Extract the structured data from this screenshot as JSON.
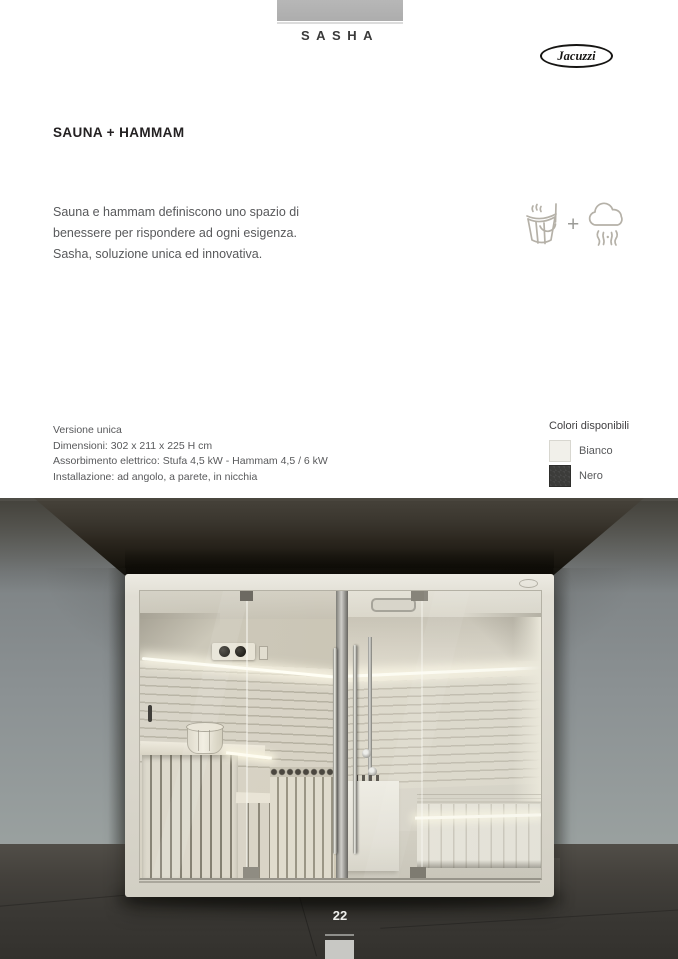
{
  "header": {
    "series": "SASHA",
    "brand": "Jacuzzi"
  },
  "main": {
    "title": "SAUNA + HAMMAM",
    "description_lines": [
      "Sauna e hammam definiscono uno spazio di",
      "benessere per rispondere ad ogni esigenza.",
      "Sasha, soluzione unica ed innovativa."
    ],
    "features": {
      "plus": "+",
      "icons": [
        "sauna-bucket-icon",
        "steam-cloud-icon"
      ],
      "icon_color": "#b5b1a8"
    },
    "specs": [
      "Versione unica",
      "Dimensioni: 302 x 211 x 225 H cm",
      "Assorbimento elettrico: Stufa 4,5 kW - Hammam 4,5 / 6 kW",
      "Installazione: ad angolo, a parete, in nicchia"
    ],
    "colors": {
      "title": "Colori disponibili",
      "options": [
        {
          "label": "Bianco",
          "hex": "#f1f0ea"
        },
        {
          "label": "Nero",
          "hex": "#3c3c3a"
        }
      ]
    }
  },
  "footer": {
    "page_number": "22"
  }
}
